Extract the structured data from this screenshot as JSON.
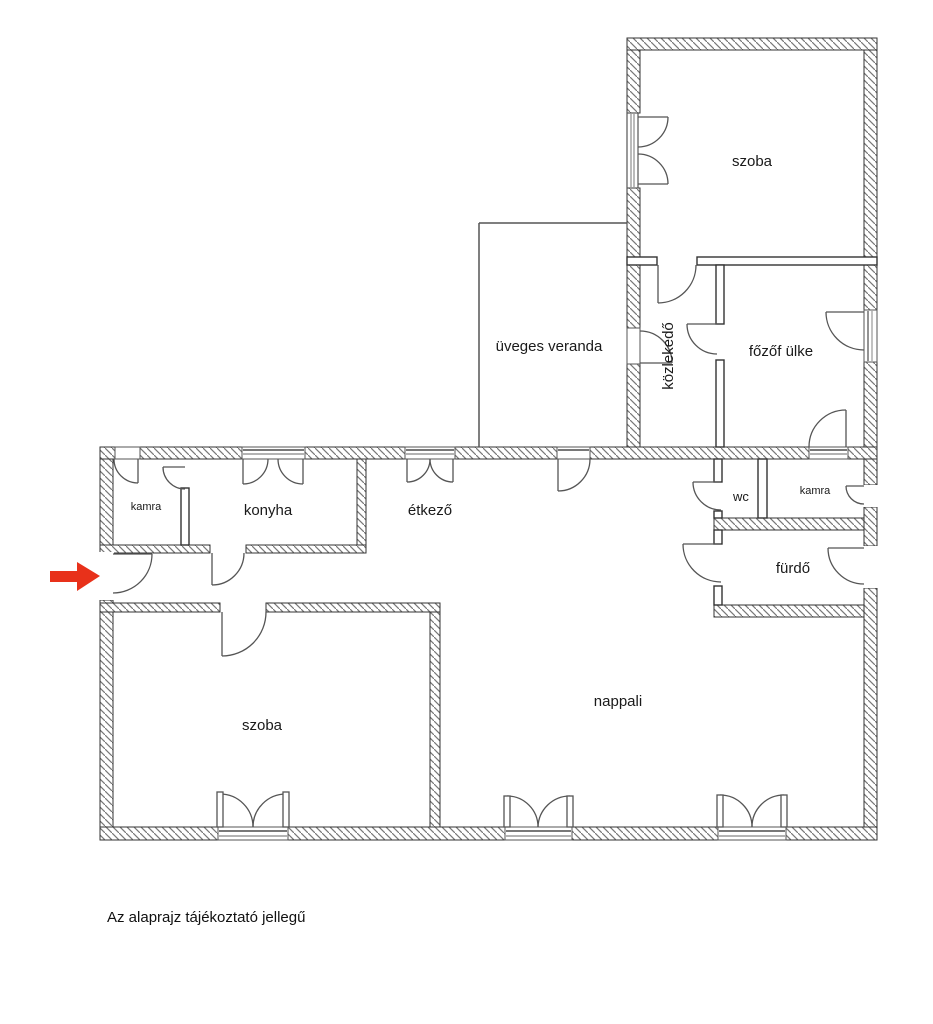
{
  "plan": {
    "disclaimer": "Az alaprajz tájékoztató jellegű",
    "rooms": [
      {
        "id": "szoba-top",
        "label": "szoba"
      },
      {
        "id": "kozlekedo",
        "label": "közlekedő"
      },
      {
        "id": "fozofulke",
        "label": "főzőf ülke"
      },
      {
        "id": "uveges-veranda",
        "label": "üveges veranda"
      },
      {
        "id": "kamra-left",
        "label": "kamra"
      },
      {
        "id": "konyha",
        "label": "konyha"
      },
      {
        "id": "etkezo",
        "label": "étkező"
      },
      {
        "id": "wc",
        "label": "wc"
      },
      {
        "id": "kamra-right",
        "label": "kamra"
      },
      {
        "id": "furdo",
        "label": "fürdő"
      },
      {
        "id": "szoba-bottom",
        "label": "szoba"
      },
      {
        "id": "nappali",
        "label": "nappali"
      }
    ],
    "entrance_marker": {
      "icon": "right-arrow-icon",
      "color": "#e8311a"
    },
    "colors": {
      "wall_outline": "#333333",
      "hatch_line": "#777777",
      "door_line": "#555555",
      "sill_gray": "#787878",
      "label_text": "#1a1a1a",
      "arrow_red": "#e8311a",
      "background": "#ffffff"
    }
  }
}
